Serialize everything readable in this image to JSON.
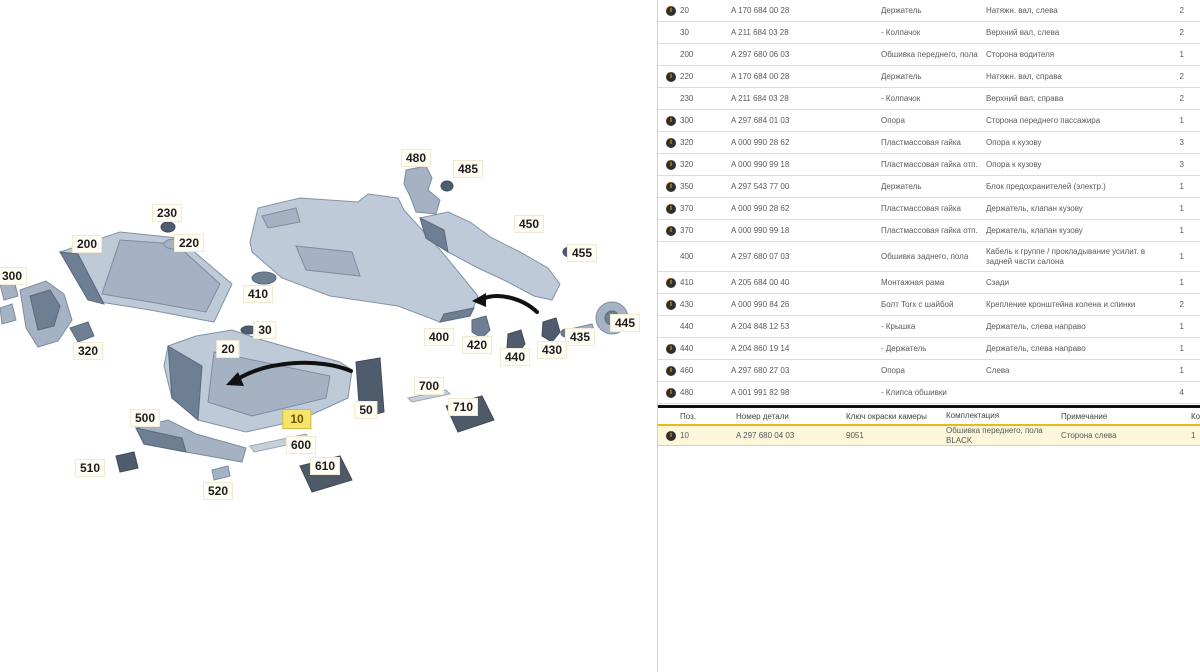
{
  "diagram": {
    "labels": [
      {
        "text": "480",
        "x": 416,
        "y": 158
      },
      {
        "text": "485",
        "x": 468,
        "y": 169
      },
      {
        "text": "450",
        "x": 529,
        "y": 224
      },
      {
        "text": "455",
        "x": 582,
        "y": 253
      },
      {
        "text": "230",
        "x": 167,
        "y": 213
      },
      {
        "text": "220",
        "x": 189,
        "y": 243
      },
      {
        "text": "200",
        "x": 87,
        "y": 244
      },
      {
        "text": "300",
        "x": 12,
        "y": 276
      },
      {
        "text": "410",
        "x": 258,
        "y": 294
      },
      {
        "text": "445",
        "x": 625,
        "y": 323
      },
      {
        "text": "435",
        "x": 580,
        "y": 337
      },
      {
        "text": "430",
        "x": 552,
        "y": 350
      },
      {
        "text": "440",
        "x": 515,
        "y": 357
      },
      {
        "text": "420",
        "x": 477,
        "y": 345
      },
      {
        "text": "400",
        "x": 439,
        "y": 337
      },
      {
        "text": "30",
        "x": 265,
        "y": 330
      },
      {
        "text": "20",
        "x": 228,
        "y": 349
      },
      {
        "text": "320",
        "x": 88,
        "y": 351
      },
      {
        "text": "700",
        "x": 429,
        "y": 386
      },
      {
        "text": "710",
        "x": 463,
        "y": 407
      },
      {
        "text": "50",
        "x": 366,
        "y": 410
      },
      {
        "text": "10",
        "x": 297,
        "y": 419,
        "highlighted": true
      },
      {
        "text": "500",
        "x": 145,
        "y": 418
      },
      {
        "text": "600",
        "x": 301,
        "y": 445
      },
      {
        "text": "510",
        "x": 90,
        "y": 468
      },
      {
        "text": "610",
        "x": 325,
        "y": 466
      },
      {
        "text": "520",
        "x": 218,
        "y": 491
      }
    ]
  },
  "parts_table": {
    "rows": [
      {
        "info": true,
        "pos": "20",
        "part": "A 170 684 00 28",
        "name": "Держатель",
        "note": "Натяжн. вал, слева",
        "qty": "2"
      },
      {
        "info": false,
        "pos": "30",
        "part": "A 211 684 03 28",
        "name": "- Колпачок",
        "note": "Верхний вал, слева",
        "qty": "2"
      },
      {
        "info": false,
        "pos": "200",
        "part": "A 297 680 06 03",
        "name": "Обшивка переднего, пола",
        "note": "Сторона водителя",
        "qty": "1"
      },
      {
        "info": true,
        "pos": "220",
        "part": "A 170 684 00 28",
        "name": "Держатель",
        "note": "Натяжн. вал, справа",
        "qty": "2"
      },
      {
        "info": false,
        "pos": "230",
        "part": "A 211 684 03 28",
        "name": "- Колпачок",
        "note": "Верхний вал, справа",
        "qty": "2"
      },
      {
        "info": true,
        "pos": "300",
        "part": "A 297 684 01 03",
        "name": "Опора",
        "note": "Сторона переднего пассажира",
        "qty": "1"
      },
      {
        "info": true,
        "pos": "320",
        "part": "A 000 990 28 62",
        "name": "Пластмассовая гайка",
        "note": "Опора к кузову",
        "qty": "3"
      },
      {
        "info": true,
        "pos": "320",
        "part": "A 000 990 99 18",
        "name": "Пластмассовая гайка отп.",
        "note": "Опора к кузову",
        "qty": "3"
      },
      {
        "info": true,
        "pos": "350",
        "part": "A 297 543 77 00",
        "name": "Держатель",
        "note": "Блок предохранителей (электр.)",
        "qty": "1"
      },
      {
        "info": true,
        "pos": "370",
        "part": "A 000 990 28 62",
        "name": "Пластмассовая гайка",
        "note": "Держатель, клапан кузову",
        "qty": "1"
      },
      {
        "info": true,
        "pos": "370",
        "part": "A 000 990 99 18",
        "name": "Пластмассовая гайка отп.",
        "note": "Держатель, клапан кузову",
        "qty": "1"
      },
      {
        "info": false,
        "pos": "400",
        "part": "A 297 680 07 03",
        "name": "Обшивка заднего, пола",
        "note": "Кабель к группе / прокладывание усилит. в задней части салона",
        "qty": "1",
        "tall": true
      },
      {
        "info": true,
        "pos": "410",
        "part": "A 205 684 00 40",
        "name": "Монтажная рама",
        "note": "Сзади",
        "qty": "1"
      },
      {
        "info": true,
        "pos": "430",
        "part": "A 000 990 84 26",
        "name": "Болт Torx с шайбой",
        "note": "Крепление кронштейна колена и спинки",
        "qty": "2"
      },
      {
        "info": false,
        "pos": "440",
        "part": "A 204 848 12 53",
        "name": "- Крышка",
        "note": "Держатель, слева направо",
        "qty": "1"
      },
      {
        "info": true,
        "pos": "440",
        "part": "A 204 860 19 14",
        "name": "- Держатель",
        "note": "Держатель, слева направо",
        "qty": "1"
      },
      {
        "info": true,
        "pos": "460",
        "part": "A 297 680 27 03",
        "name": "Опора",
        "note": "Слева",
        "qty": "1"
      },
      {
        "info": true,
        "pos": "480",
        "part": "A 001 991 82 98",
        "name": "- Клипса обшивки",
        "note": "",
        "qty": "4"
      }
    ]
  },
  "variant_table": {
    "headers": {
      "pos": "Поз.",
      "part": "Номер детали",
      "color_key": "Ключ окраски камеры",
      "name": "Комплектация",
      "note": "Примечание",
      "qty": "Кол."
    },
    "row": {
      "pos": "10",
      "part": "A 297 680 04 03",
      "color_key": "9051",
      "name": "Обшивка переднего, пола   BLACK",
      "note": "Сторона слева",
      "qty": "1"
    }
  }
}
